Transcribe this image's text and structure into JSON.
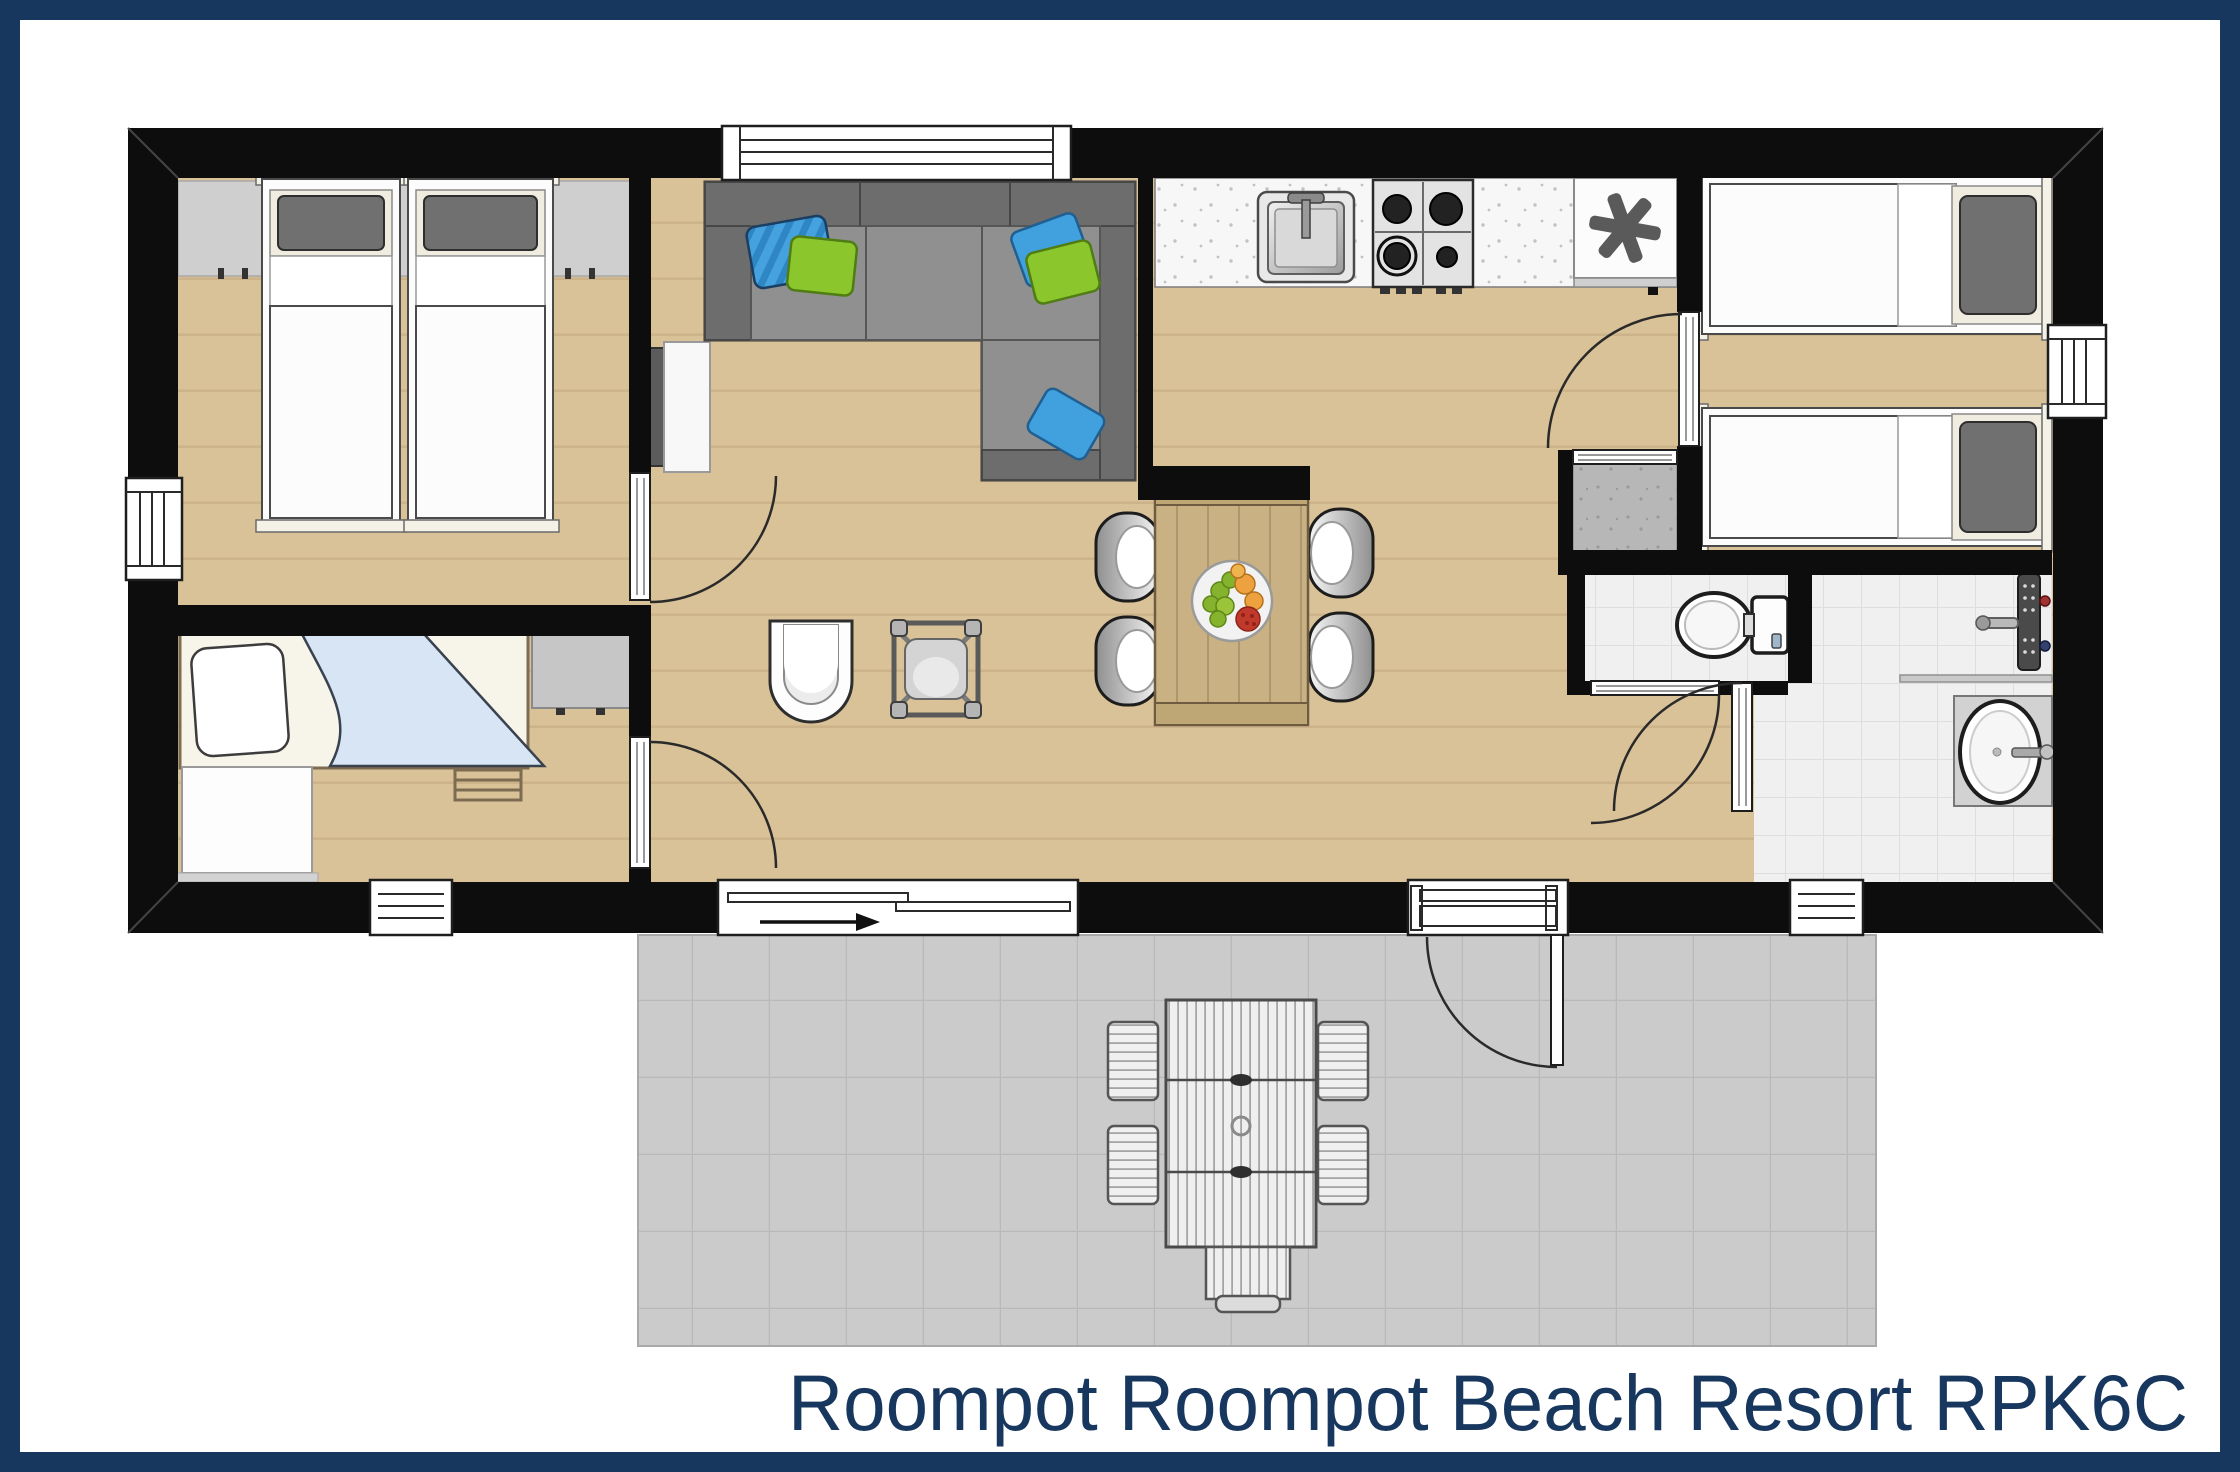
{
  "title": {
    "text": "Roompot Roompot Beach Resort RPK6C"
  },
  "colors": {
    "navy": "#17375e",
    "wall": "#0d0d0d",
    "wood": "#d9c198",
    "wood_line": "#c2a87d",
    "counter": "#f7f7f7",
    "tile": "#f0f0f0",
    "tile_line": "#dedede",
    "terrace": "#cbcbcb",
    "terrace_line": "#b9b9b9",
    "storage": "#b7b7b7",
    "headboard": "#cfcfcf",
    "sofa": "#868686",
    "sofa_dark": "#6d6d6d",
    "sofa_outline": "#3a3a3a",
    "pillow_blue": "#41a0de",
    "pillow_blue_dark": "#2f86c4",
    "pillow_green": "#8bc72c",
    "duvet": "#fcfcfc",
    "pillow_gray": "#707070",
    "mat_cream": "#f0ecdf",
    "table_wood": "#c9b183",
    "table_wood_line": "#a8906a",
    "blanket_blue": "#d7e5f4",
    "arc": "#2a2a2a"
  },
  "icons": {
    "freezer": "asterisk-star",
    "stove": "four-burner-gas-hob",
    "sink": "square-basin-with-faucet",
    "toilet": "bowl-with-cistern",
    "shower": "wall-column-with-arm",
    "washbasin": "oval-basin-on-counter",
    "entrance_arrow": "right-arrow",
    "fruit_bowl": "plate-with-fruit"
  }
}
